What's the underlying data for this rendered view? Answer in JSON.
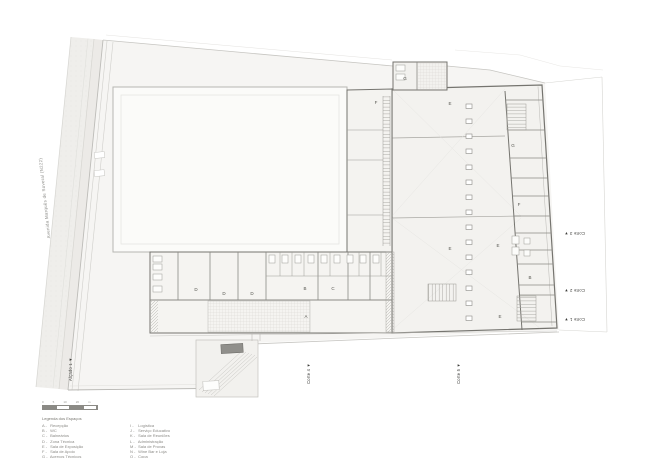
{
  "drawing": {
    "street_label": "Avenida Marquês de Soveral (N222)",
    "room_labels": [
      {
        "text": "F"
      },
      {
        "text": "E"
      },
      {
        "text": "G"
      },
      {
        "text": "G"
      },
      {
        "text": "F"
      },
      {
        "text": "E"
      },
      {
        "text": "E"
      },
      {
        "text": "B"
      },
      {
        "text": "E"
      },
      {
        "text": "D"
      },
      {
        "text": "D"
      },
      {
        "text": "D"
      },
      {
        "text": "B"
      },
      {
        "text": "C"
      },
      {
        "text": "A"
      }
    ],
    "section_markers": [
      {
        "label": "Corte 3 ▼"
      },
      {
        "label": "Corte 2 ▼"
      },
      {
        "label": "Corte 1 ▼"
      },
      {
        "label": "Corte 4 ▼"
      },
      {
        "label": "Corte 5 ▼"
      },
      {
        "label": "Alçado 1 ▼"
      }
    ]
  },
  "scalebar": {
    "ticks": [
      "0",
      "5",
      "10",
      "20"
    ],
    "unit": "m"
  },
  "legend": {
    "title": "Legenda dos Espaços",
    "items": [
      {
        "key": "A -",
        "label": "Recepção"
      },
      {
        "key": "B -",
        "label": "WC"
      },
      {
        "key": "C -",
        "label": "Balneários"
      },
      {
        "key": "D -",
        "label": "Zona Técnica"
      },
      {
        "key": "E -",
        "label": "Sala de Exposição"
      },
      {
        "key": "F -",
        "label": "Sala de Apoio"
      },
      {
        "key": "G -",
        "label": "Acervos Técnicos"
      },
      {
        "key": "H -",
        "label": "Loja de Turismo e Exposições Temporárias"
      },
      {
        "key": "I -",
        "label": "Logística"
      },
      {
        "key": "J -",
        "label": "Serviço Educativo"
      },
      {
        "key": "K -",
        "label": "Sala de Reuniões"
      },
      {
        "key": "L -",
        "label": "Administração"
      },
      {
        "key": "M -",
        "label": "Sala de Provas"
      },
      {
        "key": "N -",
        "label": "Wine Bar e Loja"
      },
      {
        "key": "O -",
        "label": "Copa"
      }
    ]
  },
  "colors": {
    "paper": "#ffffff",
    "site_fill": "#f6f5f3",
    "wall": "#75746f",
    "light_line": "#c9c8c4",
    "text": "#55554f"
  }
}
